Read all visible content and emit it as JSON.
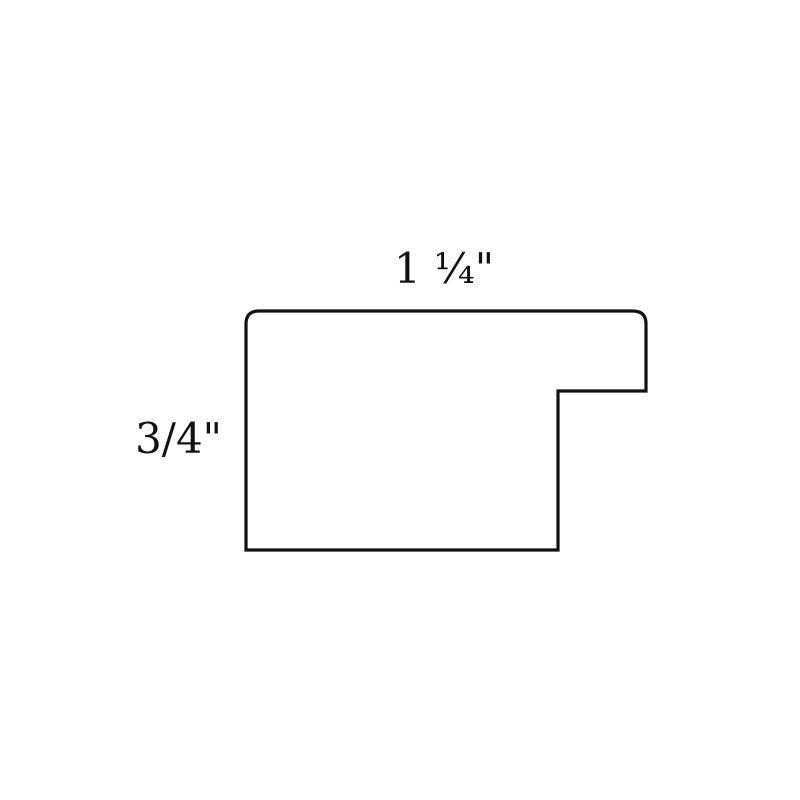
{
  "diagram": {
    "width_label": "1 ¼\"",
    "height_label": "3/4\"",
    "outline_color": "#111111",
    "fill_color": "#ffffff",
    "background_color": "#ffffff"
  }
}
